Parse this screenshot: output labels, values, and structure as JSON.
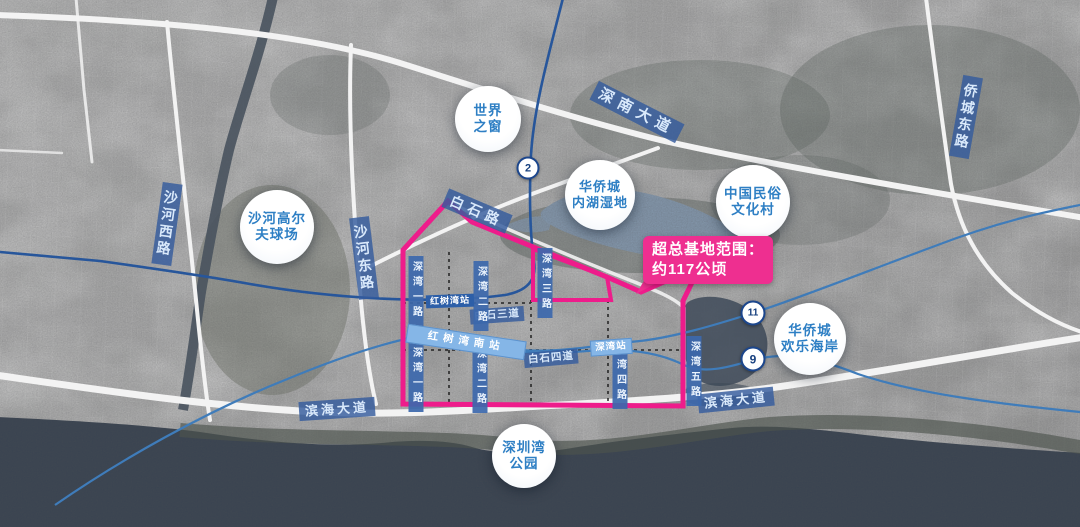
{
  "map": {
    "base_area_label": {
      "line1": "超总基地范围：",
      "line2": "约117公顷"
    },
    "places": [
      {
        "name": "世界之窗",
        "line1": "世界",
        "line2": "之窗"
      },
      {
        "name": "华侨城内湖湿地",
        "line1": "华侨城",
        "line2": "内湖湿地"
      },
      {
        "name": "中国民俗文化村",
        "line1": "中国民俗",
        "line2": "文化村"
      },
      {
        "name": "沙河高尔夫球场",
        "line1": "沙河高尔",
        "line2": "夫球场"
      },
      {
        "name": "华侨城欢乐海岸",
        "line1": "华侨城",
        "line2": "欢乐海岸"
      },
      {
        "name": "深圳湾公园",
        "line1": "深圳湾",
        "line2": "公园"
      }
    ],
    "road_labels": {
      "shennan": "深南大道",
      "qiaocheng_east": "侨城东路",
      "shahe_west": "沙河西路",
      "shahe_east": "沙河东路",
      "baishi": "白石路",
      "baishi3": "白石三道",
      "baishi4": "白石四道",
      "binhai_left": "滨海大道",
      "binhai_right": "滨海大道",
      "shenwan1_upper": "深湾一路",
      "shenwan2_upper": "深湾二路",
      "shenwan3": "深湾三路",
      "shenwan1_lower": "深湾一路",
      "shenwan2_lower": "深湾二路",
      "shenwan4": "深湾四路",
      "shenwan5": "深湾五路"
    },
    "stations": {
      "hongshuwan": "红树湾站",
      "hongshuwan_south": "红树湾南站",
      "shenwan": "深湾站"
    },
    "metro_badges": {
      "line2": "2",
      "line11": "11",
      "line9": "9"
    },
    "colors": {
      "boundary_pink": "#ee1c8b",
      "place_text_blue": "#2e7fc4",
      "road_label_blue": "#34509e",
      "metro_dark_blue": "#27569b",
      "metro_light_blue": "#3f7cba",
      "station_band_blue": "#85b6e7",
      "sea": "#3a4451"
    }
  }
}
